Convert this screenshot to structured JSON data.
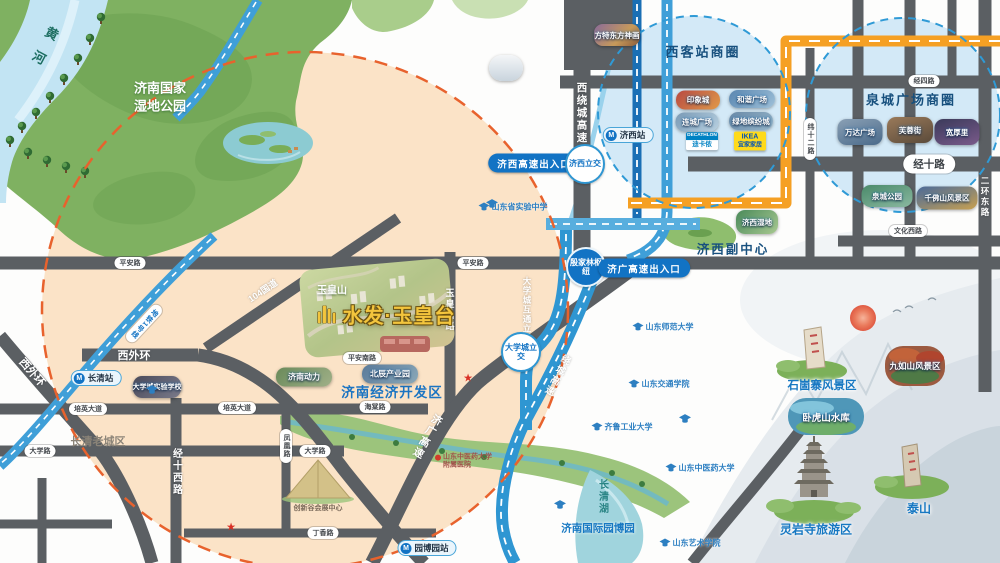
{
  "project": {
    "name": "水发·玉皇台"
  },
  "nature": {
    "river": "黄河",
    "wetland_park": "济南国家湿地公园",
    "lake": "长清湖",
    "expo_park": "济南国际园博园"
  },
  "districts": {
    "jixi_sub": "济西副中心",
    "jingkai": "济南经济开发区",
    "cq_old": "长清老城区",
    "yuhuangshan": "玉皇山"
  },
  "circles": {
    "west": {
      "title": "西客站商圈",
      "malls": [
        "印象城",
        "和谐广场",
        "连城广场",
        "绿地缤纷城"
      ],
      "brand_dec_en": "DECATHLON",
      "brand_dec_cn": "迪卡侬",
      "brand_ikea_en": "IKEA",
      "brand_ikea_cn": "宜家家居"
    },
    "quancheng": {
      "title": "泉城广场商圈",
      "spots": [
        "万达广场",
        "芙蓉街",
        "宽厚里",
        "泉城公园",
        "千佛山风景区"
      ]
    }
  },
  "roads": {
    "xiraocheng": "西绕城高速",
    "jingsi": "经四路",
    "jingshi": "经十路",
    "wenhuaxi": "文化西路",
    "erhuandong": "二环东路",
    "weishier": "纬十二路",
    "xiwaihuan": "西外环",
    "guodao104": "104国道",
    "pingan": "平安路",
    "pingannan": "平安南路",
    "peiying": "培英大道",
    "daxuelu": "大学路",
    "haitang": "海棠路",
    "dingxiang": "丁香路",
    "fenghuang": "凤凰路",
    "jingshixi": "经十西路",
    "yuhuangshanlu": "玉皇山路",
    "dxc_hutong": "大学城互通立交",
    "metro1": "地铁1号线",
    "raocheng": "绕城高速",
    "jiguang": "济广高速"
  },
  "stations": {
    "jixi": "济西站",
    "changqing": "长清站",
    "yuanboyuan": "园博园站"
  },
  "junctions": {
    "jixi": "济西立交",
    "yinjialin": "殷家林枢纽",
    "daxuecheng": "大学城立交"
  },
  "gates": {
    "jixi": "济西高速出入口",
    "jiguang": "济广高速出入口"
  },
  "thumbs": {
    "fangte": "方特东方神画",
    "shidi": "济西湿地",
    "dongli": "济南动力",
    "beichen": "北辰产业园",
    "shiyan_school": "大学城实验学校",
    "cxg": "创新谷会展中心"
  },
  "scenic": {
    "shigu": "石崮寨风景区",
    "jiuru": "九如山风景区",
    "wohu": "卧虎山水库",
    "lingyan": "灵岩寺旅游区",
    "taishan": "泰山"
  },
  "pois": {
    "sd_shiyan": "山东省实验中学",
    "shida": "山东师范大学",
    "jiaotong": "山东交通学院",
    "qilu": "齐鲁工业大学",
    "zhongyi": "山东中医药大学",
    "hospital": "山东中医药大学附属医院",
    "yishu": "山东艺术学院"
  },
  "colors": {
    "peach": "#fbe3c7",
    "road_dark": "#5b5f63",
    "road_blue": "#2f96d2",
    "road_orange": "#f5a024",
    "radius_dash": "#e8622d",
    "circle_fill": "#cfe7f6",
    "circle_dash": "#2f9ad6",
    "label_blue": "#1273c4",
    "project_gold": "#f3c53d"
  }
}
